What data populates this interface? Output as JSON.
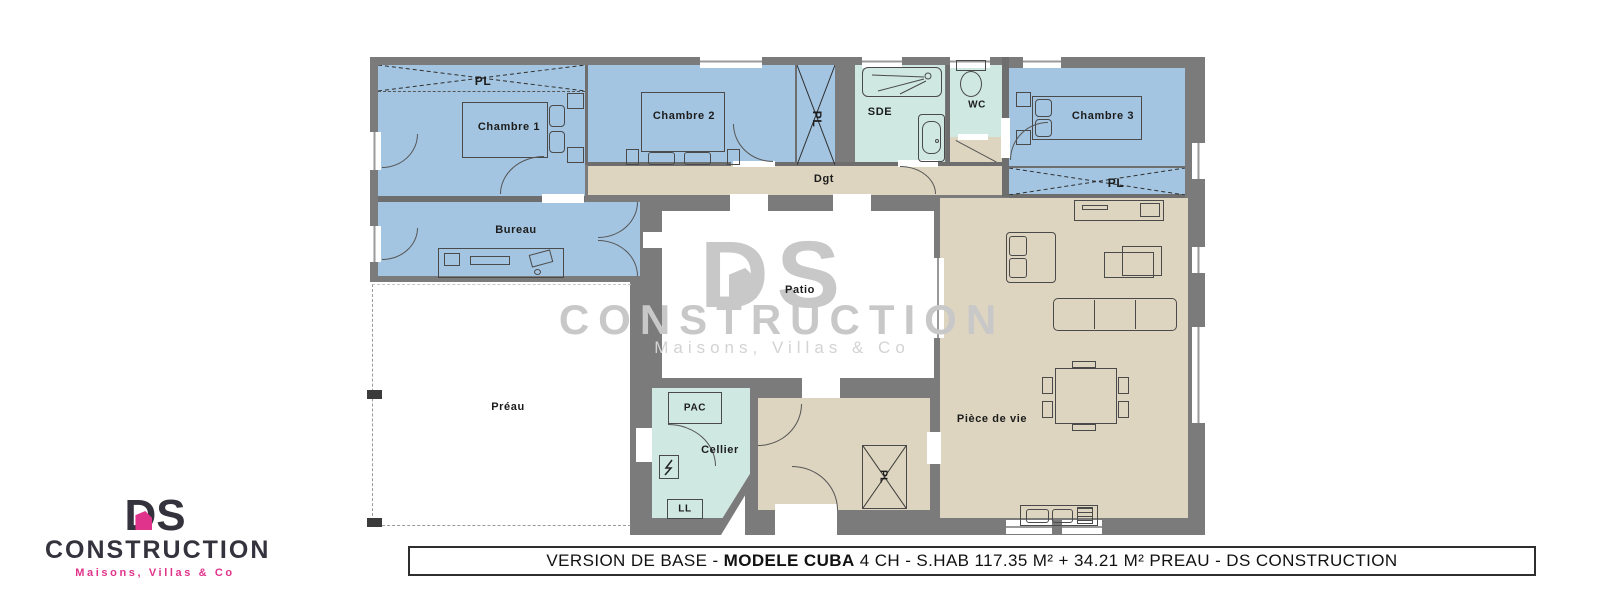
{
  "banner": {
    "prefix": "VERSION DE BASE - ",
    "model": "MODELE CUBA",
    "suffix": " 4 CH - S.HAB 117.35 M² + 34.21 M² PREAU - DS CONSTRUCTION"
  },
  "watermark": {
    "name": "DS",
    "word": "CONSTRUCTION",
    "tagline": "Maisons, Villas & Co"
  },
  "logo": {
    "name": "DS",
    "word": "CONSTRUCTION",
    "tagline": "Maisons, Villas & Co"
  },
  "rooms": {
    "chambre1": "Chambre 1",
    "chambre2": "Chambre 2",
    "chambre3": "Chambre 3",
    "sde": "SDE",
    "wc": "WC",
    "dgt": "Dgt",
    "bureau": "Bureau",
    "patio": "Patio",
    "preau": "Préau",
    "cellier": "Cellier",
    "piece_de_vie": "Pièce de vie",
    "pac": "PAC",
    "ll": "LL"
  },
  "labels": {
    "closet": "PL"
  },
  "colors": {
    "wall": "#7b7b7b",
    "wall2": "#6e6e6e",
    "bedroom_blue": "#a3c5e1",
    "wet_teal": "#cfe8e2",
    "floor_beige": "#ddd5bf",
    "watermark_gray": "#c8c8c8",
    "watermark_light": "#d3d3d3",
    "logo_ink": "#34333d",
    "logo_pink": "#e0338b"
  }
}
